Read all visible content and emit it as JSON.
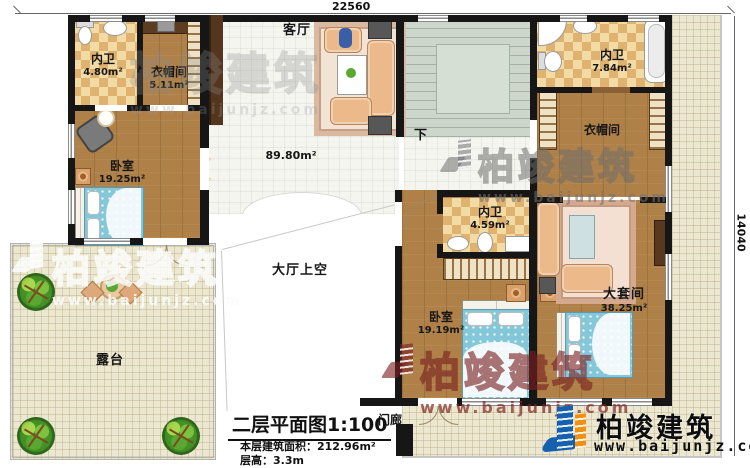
{
  "dimensions": {
    "top": "22560",
    "right": "14040"
  },
  "rooms": {
    "bath1": {
      "label": "内卫",
      "area": "4.80m²"
    },
    "cloak1": {
      "label": "衣帽间",
      "area": "5.11m²"
    },
    "living": {
      "label": "客厅",
      "area": "89.80m²"
    },
    "bath2": {
      "label": "内卫",
      "area": "7.84m²"
    },
    "cloak2": {
      "label": "衣帽间"
    },
    "bedroom1": {
      "label": "卧室",
      "area": "19.25m²"
    },
    "terrace": {
      "label": "露台"
    },
    "hallvoid": {
      "label": "大厅上空"
    },
    "bath3": {
      "label": "内卫",
      "area": "4.59m²"
    },
    "bedroom2": {
      "label": "卧室",
      "area": "19.19m²"
    },
    "suite": {
      "label": "大套间",
      "area": "38.25m²"
    },
    "porch": {
      "label": "门廊"
    }
  },
  "stairs": {
    "down_label": "下"
  },
  "title_block": {
    "title": "二层平面图1:100",
    "area_line": "本层建筑面积：212.96m²",
    "floor_height_line": "层高：3.3m"
  },
  "branding": {
    "name": "柏竣建筑",
    "url": "www.baijunjz.com"
  },
  "watermark": {
    "name": "柏竣建筑",
    "url": "www.baijunjz.com"
  },
  "colors": {
    "wood": "#af8148",
    "checker_light": "#f2dba4",
    "checker_dark": "#dfb270",
    "stair": "#ccd6cb",
    "terrace": "#ece7d0",
    "wall": "#161616",
    "bed_blue": "#84c7d8",
    "sofa_peach": "#ecb98b",
    "logo_blue": "#1660b0",
    "logo_orange": "#f29111",
    "watermark_red": "#7c2626"
  }
}
